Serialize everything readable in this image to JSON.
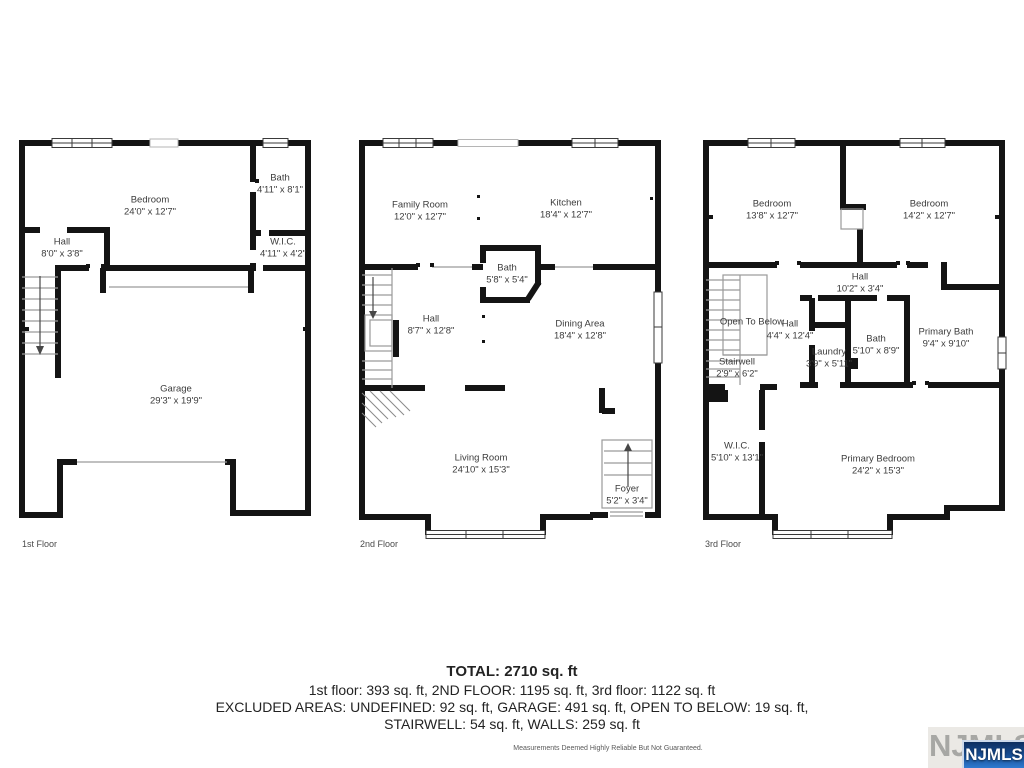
{
  "floors": [
    {
      "label": "1st Floor",
      "rooms": [
        {
          "name": "Bedroom",
          "dims": "24'0\" x 12'7\""
        },
        {
          "name": "Bath",
          "dims": "4'11\" x 8'1\""
        },
        {
          "name": "Hall",
          "dims": "8'0\" x 3'8\""
        },
        {
          "name": "W.I.C.",
          "dims": "4'11\" x 4'2\""
        },
        {
          "name": "Garage",
          "dims": "29'3\" x 19'9\""
        }
      ]
    },
    {
      "label": "2nd Floor",
      "rooms": [
        {
          "name": "Family Room",
          "dims": "12'0\" x 12'7\""
        },
        {
          "name": "Kitchen",
          "dims": "18'4\" x 12'7\""
        },
        {
          "name": "Bath",
          "dims": "5'8\" x 5'4\""
        },
        {
          "name": "Hall",
          "dims": "8'7\" x 12'8\""
        },
        {
          "name": "Dining Area",
          "dims": "18'4\" x 12'8\""
        },
        {
          "name": "Living Room",
          "dims": "24'10\" x 15'3\""
        },
        {
          "name": "Foyer",
          "dims": "5'2\" x 3'4\""
        }
      ]
    },
    {
      "label": "3rd Floor",
      "rooms": [
        {
          "name": "Bedroom",
          "dims": "13'8\" x 12'7\""
        },
        {
          "name": "Bedroom",
          "dims": "14'2\" x 12'7\""
        },
        {
          "name": "Hall",
          "dims": "10'2\" x 3'4\""
        },
        {
          "name": "Open To Below",
          "dims": ""
        },
        {
          "name": "Hall",
          "dims": "4'4\" x 12'4\""
        },
        {
          "name": "Laundry",
          "dims": "3'9\" x 5'11\""
        },
        {
          "name": "Bath",
          "dims": "5'10\" x 8'9\""
        },
        {
          "name": "Primary Bath",
          "dims": "9'4\" x 9'10\""
        },
        {
          "name": "Stairwell",
          "dims": "2'9\" x 6'2\""
        },
        {
          "name": "W.I.C.",
          "dims": "5'10\" x 13'1\""
        },
        {
          "name": "Primary Bedroom",
          "dims": "24'2\" x 15'3\""
        }
      ]
    }
  ],
  "summary": {
    "total": "TOTAL: 2710 sq. ft",
    "floors_line": "1st floor: 393 sq. ft, 2ND FLOOR: 1195 sq. ft, 3rd floor: 1122 sq. ft",
    "excluded_line1": "EXCLUDED AREAS: UNDEFINED: 92 sq. ft, GARAGE: 491 sq. ft, OPEN TO BELOW: 19 sq. ft,",
    "excluded_line2": "STAIRWELL: 54 sq. ft, WALLS: 259 sq. ft"
  },
  "disclaimer": "Measurements Deemed Highly Reliable But Not Guaranteed.",
  "logo": {
    "watermark": "NJMLS",
    "badge": "NJMLS"
  }
}
